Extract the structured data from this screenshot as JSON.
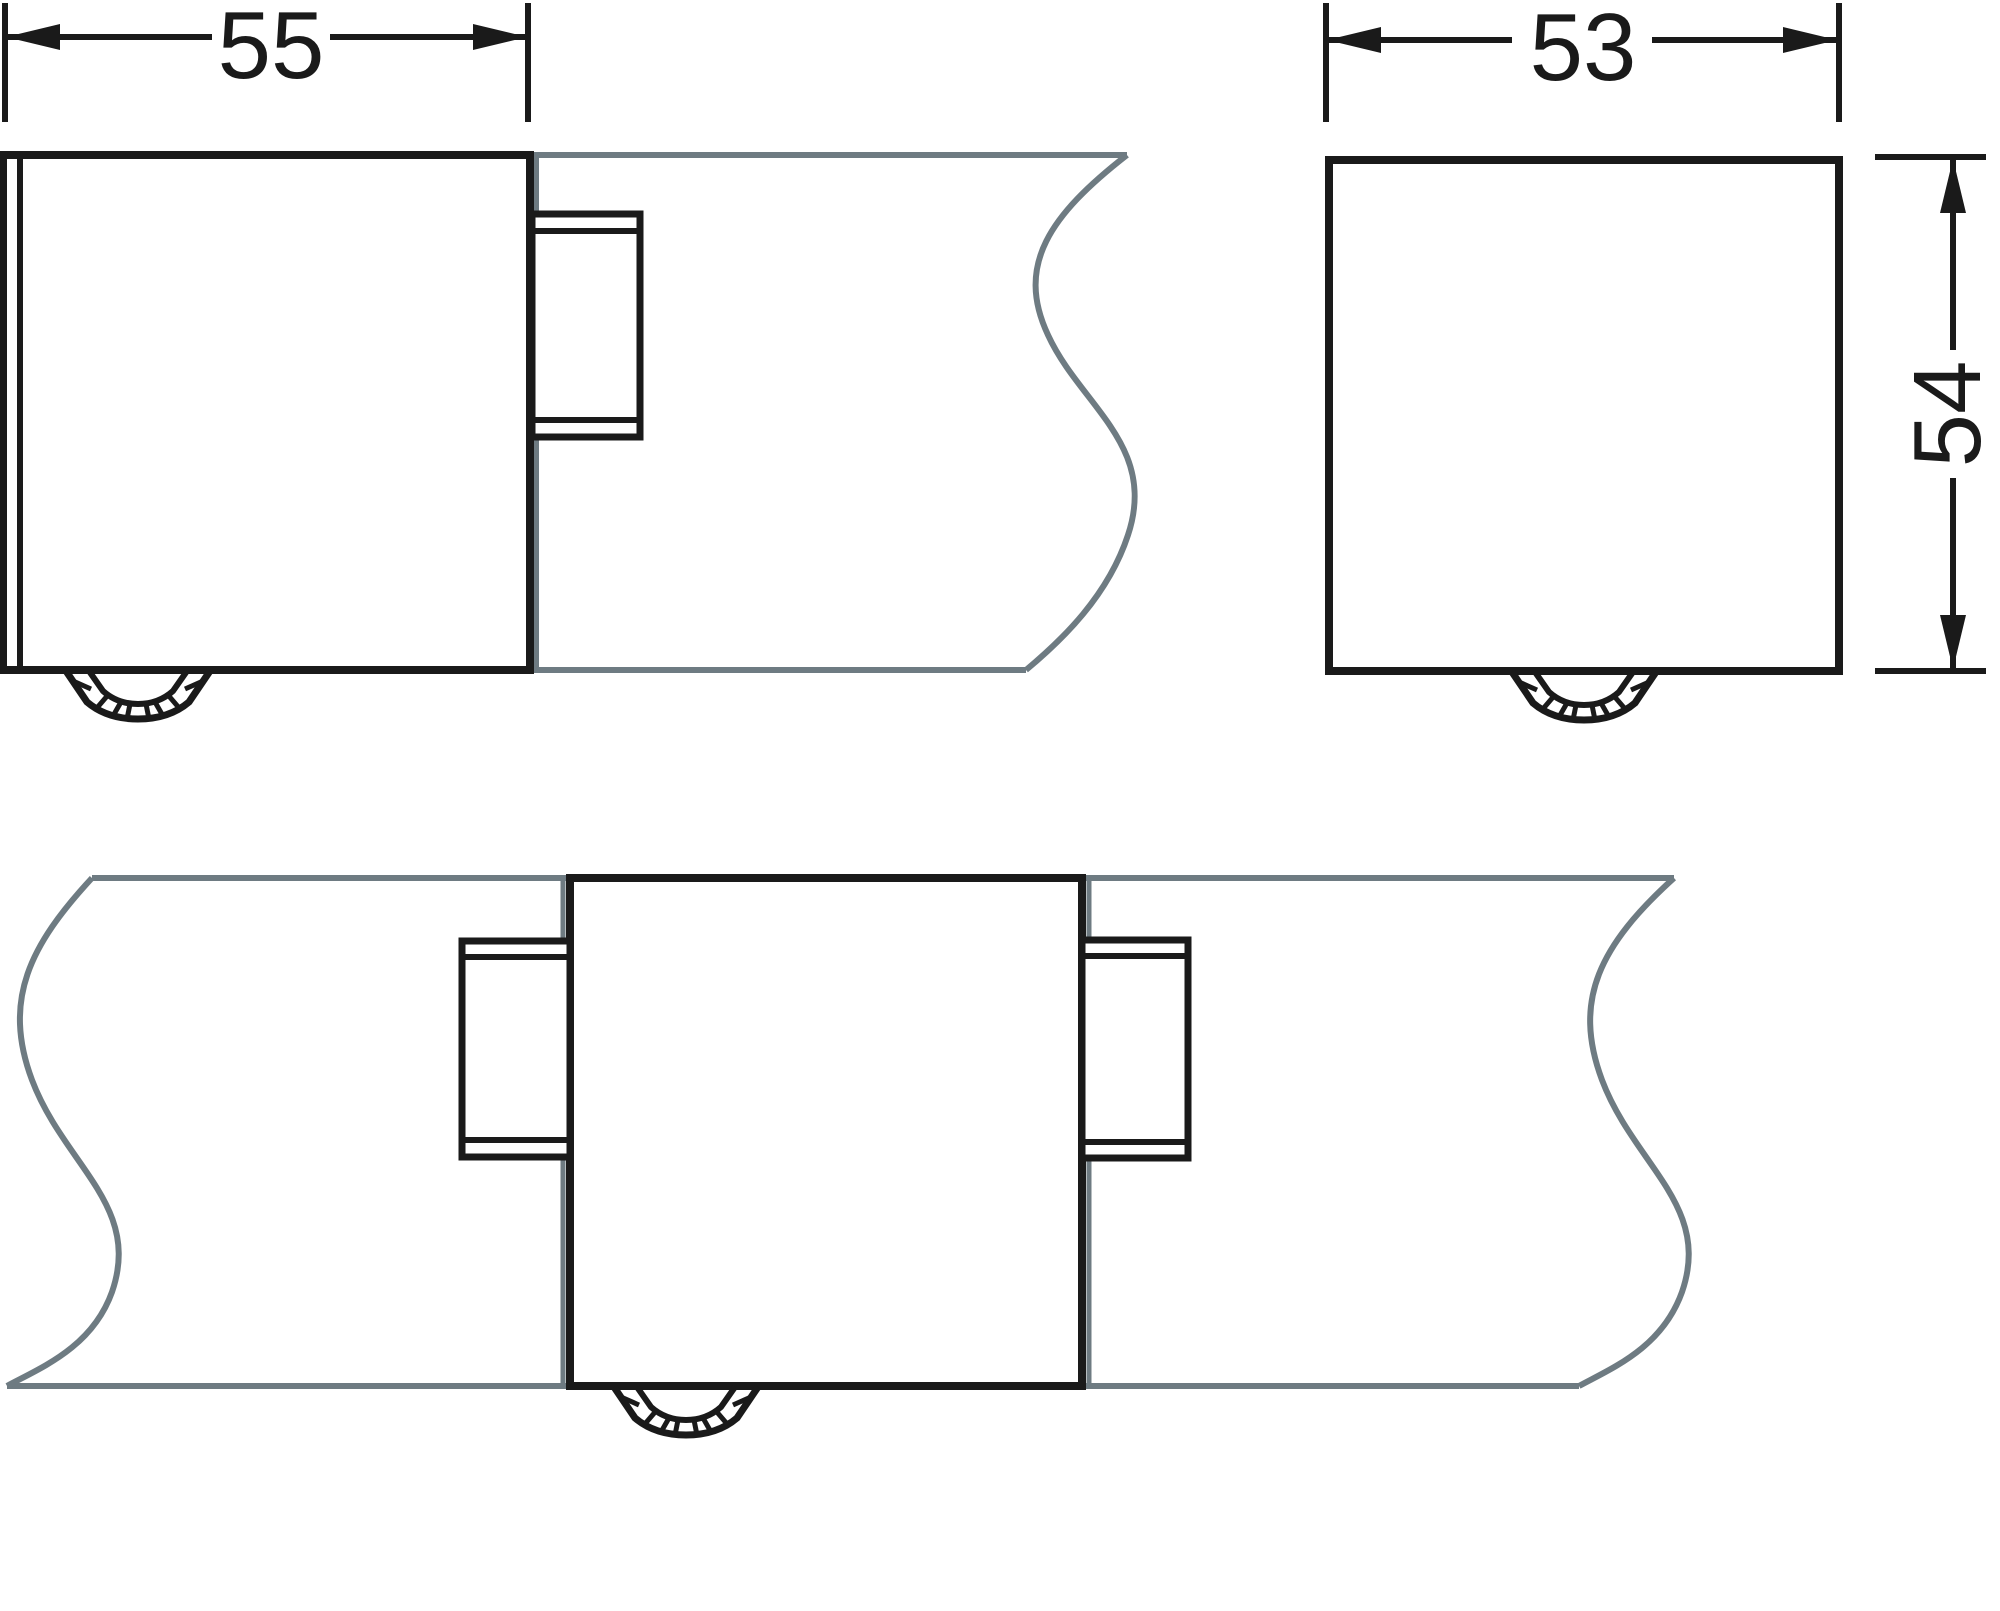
{
  "drawing": {
    "type": "technical-dimension-drawing",
    "views": {
      "end_cap_side_view": "end cap on trunking profile, side view",
      "end_cap_front_view": "end cap, front view",
      "coupler_front_view": "coupler between two trunking profiles, front view"
    },
    "dimensions": {
      "end_view_width": "55",
      "front_view_width": "53",
      "front_view_height": "54"
    },
    "colors": {
      "line": "#1a1a1a",
      "break_line": "#6e7b82",
      "background": "#ffffff"
    }
  }
}
